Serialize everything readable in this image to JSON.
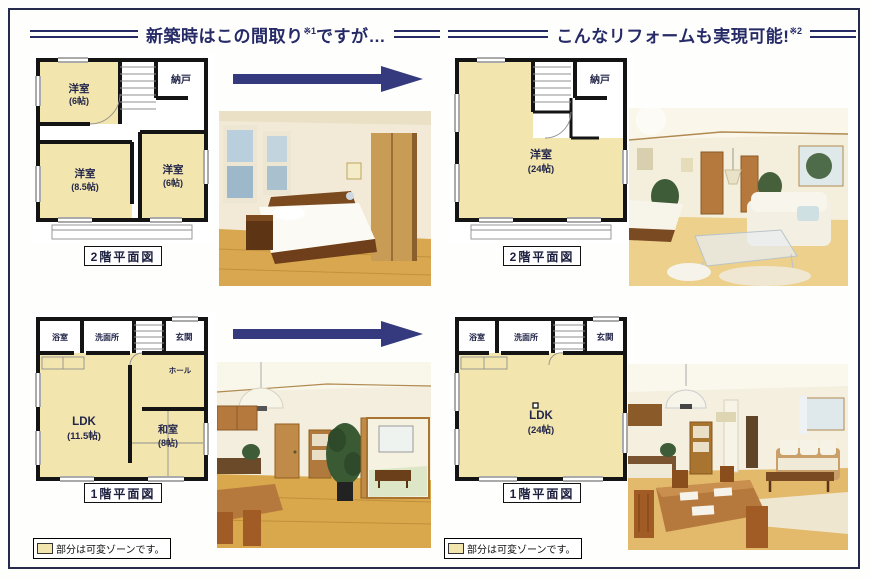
{
  "header": {
    "before": {
      "title": "新築時はこの間取り",
      "sup": "※1",
      "tail": "ですが…"
    },
    "after": {
      "title": "こんなリフォームも実現可能!",
      "sup": "※2"
    }
  },
  "plans": {
    "before_2f": {
      "caption": "2階平面図",
      "rooms": {
        "r1": {
          "name": "洋室",
          "size": "(6帖)"
        },
        "closet": {
          "name": "納戸"
        },
        "r2": {
          "name": "洋室",
          "size": "(8.5帖)"
        },
        "r3": {
          "name": "洋室",
          "size": "(6帖)"
        }
      }
    },
    "after_2f": {
      "caption": "2階平面図",
      "rooms": {
        "main": {
          "name": "洋室",
          "size": "(24帖)"
        },
        "closet": {
          "name": "納戸"
        }
      }
    },
    "before_1f": {
      "caption": "1階平面図",
      "rooms": {
        "bath": {
          "name": "浴室"
        },
        "wash": {
          "name": "洗面所"
        },
        "entrance": {
          "name": "玄関"
        },
        "hall": {
          "name": "ホール"
        },
        "ldk": {
          "name": "LDK",
          "size": "(11.5帖)"
        },
        "washitsu": {
          "name": "和室",
          "size": "(8帖)"
        }
      }
    },
    "after_1f": {
      "caption": "1階平面図",
      "rooms": {
        "bath": {
          "name": "浴室"
        },
        "wash": {
          "name": "洗面所"
        },
        "entrance": {
          "name": "玄関"
        },
        "ldk": {
          "name": "LDK",
          "size": "(24帖)"
        }
      }
    }
  },
  "legend": {
    "before": "部分は可変ゾーンです。",
    "after": "部分は可変ゾーンです。"
  },
  "colors": {
    "accent_navy": "#262a66",
    "arrow_navy": "#343a7d",
    "room_fill": "#f2e6ae",
    "wall": "#141414",
    "frame": "#262a4d"
  }
}
